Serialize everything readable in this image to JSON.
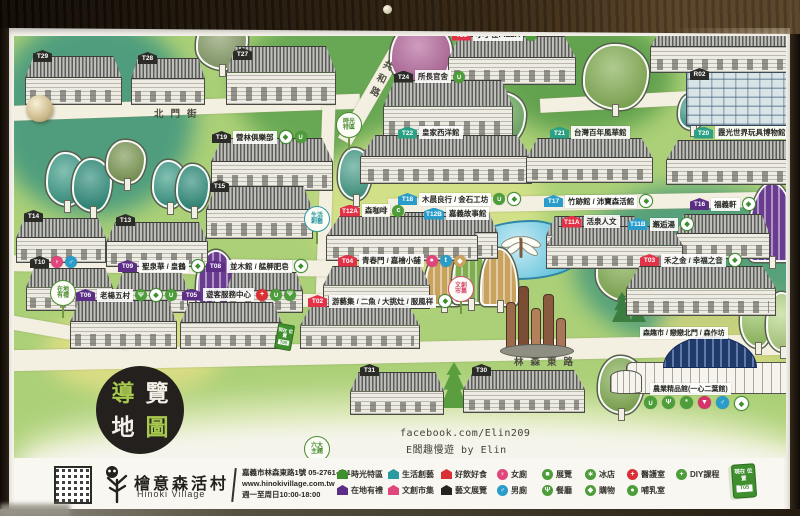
{
  "sign_title": {
    "guide_chars": [
      "導",
      "覽",
      "地",
      "圖"
    ]
  },
  "streets": {
    "beimen": "北門街",
    "gonghe": "共和路",
    "linsen": "林森東路"
  },
  "credit": {
    "line1": "facebook.com/Elin209",
    "line2": "E闆趣慢遊 by Elin"
  },
  "you_are_here": {
    "label": "現在位置",
    "code": "T05"
  },
  "marker_colors": {
    "black": "#2b2b28",
    "red": "#e23248",
    "blue": "#2a9cc9",
    "teal": "#2ba084",
    "purple": "#5c2e85",
    "pink": "#e0457b",
    "green": "#3f8f2f"
  },
  "map": {
    "area_tags": [
      {
        "line1": "時光",
        "line2": "特區",
        "color": "#4a8a2f",
        "x": 336,
        "y": 112
      },
      {
        "line1": "生活",
        "line2": "創藝",
        "color": "#2b9aa0",
        "x": 304,
        "y": 206
      },
      {
        "line1": "在地",
        "line2": "有禮",
        "color": "#4a8a2f",
        "x": 50,
        "y": 280
      },
      {
        "line1": "文創",
        "line2": "市集",
        "color": "#d84a6e",
        "x": 448,
        "y": 276
      },
      {
        "line1": "六大",
        "line2": "主題",
        "color": "#4a8a2f",
        "x": 304,
        "y": 436
      }
    ],
    "labels": [
      {
        "code": "T29",
        "cat": "black",
        "name": "",
        "icons": [],
        "x": 33,
        "y": 50
      },
      {
        "code": "T28",
        "cat": "black",
        "name": "",
        "icons": [],
        "x": 138,
        "y": 52
      },
      {
        "code": "T27",
        "cat": "black",
        "name": "",
        "icons": [],
        "x": 233,
        "y": 48
      },
      {
        "code": "T26",
        "cat": "red",
        "name": "小手在PIZZA",
        "icons": [
          "food"
        ],
        "x": 452,
        "y": 28
      },
      {
        "code": "T25",
        "cat": "black",
        "name": "阿里山林業史館",
        "icons": [],
        "x": 688,
        "y": 22
      },
      {
        "code": "R02",
        "cat": "black",
        "name": "",
        "icons": [],
        "x": 690,
        "y": 68
      },
      {
        "code": "T24",
        "cat": "black",
        "name": "所長官舍",
        "icons": [
          "drink"
        ],
        "x": 394,
        "y": 70
      },
      {
        "code": "T22",
        "cat": "teal",
        "name": "皇家西洋館",
        "icons": [],
        "x": 398,
        "y": 126
      },
      {
        "code": "T21",
        "cat": "teal",
        "name": "台灣百年風華館",
        "icons": [],
        "x": 550,
        "y": 126
      },
      {
        "code": "T20",
        "cat": "teal",
        "name": "霞光世界玩具博物館",
        "icons": [],
        "x": 694,
        "y": 126
      },
      {
        "code": "T19",
        "cat": "black",
        "name": "營林俱樂部",
        "icons": [
          "bag",
          "drink"
        ],
        "x": 212,
        "y": 130
      },
      {
        "code": "T15",
        "cat": "black",
        "name": "",
        "icons": [],
        "x": 210,
        "y": 180
      },
      {
        "code": "T14",
        "cat": "black",
        "name": "",
        "icons": [],
        "x": 24,
        "y": 210
      },
      {
        "code": "T13",
        "cat": "black",
        "name": "",
        "icons": [],
        "x": 116,
        "y": 214
      },
      {
        "code": "T18",
        "cat": "blue",
        "name": "木晨良行 / 金石工坊",
        "icons": [
          "drink",
          "bag"
        ],
        "x": 398,
        "y": 192
      },
      {
        "code": "T17",
        "cat": "blue",
        "name": "竹跡館 / 沛寶森活館",
        "icons": [
          "bag"
        ],
        "x": 544,
        "y": 194
      },
      {
        "code": "T16",
        "cat": "purple",
        "name": "福義軒",
        "icons": [
          "bag"
        ],
        "x": 690,
        "y": 197
      },
      {
        "code": "T12A",
        "cat": "red",
        "name": "森咖啡",
        "icons": [
          "coffee"
        ],
        "x": 340,
        "y": 204
      },
      {
        "code": "T12B",
        "cat": "blue",
        "name": "嘉義故事館",
        "icons": [],
        "x": 424,
        "y": 207
      },
      {
        "code": "T11A",
        "cat": "red",
        "name": "活泉人文",
        "icons": [],
        "x": 562,
        "y": 215
      },
      {
        "code": "T11B",
        "cat": "blue",
        "name": "邂逅湯",
        "icons": [
          "bag"
        ],
        "x": 628,
        "y": 217
      },
      {
        "code": "T10",
        "cat": "black",
        "name": "",
        "icons": [
          "female",
          "male"
        ],
        "x": 30,
        "y": 256
      },
      {
        "code": "T09",
        "cat": "purple",
        "name": "聖泉華 / 皇鶴",
        "icons": [
          "bag"
        ],
        "x": 118,
        "y": 259
      },
      {
        "code": "T08",
        "cat": "purple",
        "name": "並木館 / 艋舺肥皂",
        "icons": [
          "bag"
        ],
        "x": 206,
        "y": 259
      },
      {
        "code": "T06",
        "cat": "purple",
        "name": "老楊五村",
        "icons": [
          "food",
          "bag",
          "drink"
        ],
        "x": 76,
        "y": 288
      },
      {
        "code": "T05",
        "cat": "purple",
        "name": "遊客服務中心",
        "icons": [
          "cross",
          "drink",
          "food"
        ],
        "x": 182,
        "y": 288
      },
      {
        "code": "T04",
        "cat": "red",
        "name": "青春門 / 嘉檜小舖",
        "icons": [
          "photo",
          "key",
          "bagtan"
        ],
        "x": 338,
        "y": 254
      },
      {
        "code": "T02",
        "cat": "red",
        "name": "游藝集 / 二魚 / 大挑灶 / 服風祥",
        "icons": [
          "bag"
        ],
        "x": 308,
        "y": 294
      },
      {
        "code": "T03",
        "cat": "red",
        "name": "禾之金 / 幸福之音",
        "icons": [
          "bag"
        ],
        "x": 640,
        "y": 253
      },
      {
        "code": "T31",
        "cat": "black",
        "name": "",
        "icons": [],
        "x": 360,
        "y": 364
      },
      {
        "code": "T30",
        "cat": "black",
        "name": "",
        "icons": [],
        "x": 472,
        "y": 364
      }
    ],
    "shop_strip": {
      "text": "森趣市 / 戀戀北門 / 森作坊",
      "x": 638,
      "y": 327
    },
    "dome": {
      "name": "農業精品館(一心二葉館)",
      "x": 626,
      "y": 336,
      "w": 166,
      "h": 58,
      "label_x": 648,
      "label_y": 383,
      "icons": [
        "drink",
        "food",
        "leaf",
        "icecream",
        "male",
        "bag"
      ],
      "icons_x": 642,
      "icons_y": 396
    },
    "structures": [
      {
        "k": "house",
        "x": 25,
        "y": 56,
        "w": 97,
        "h": 46
      },
      {
        "k": "house",
        "x": 131,
        "y": 58,
        "w": 74,
        "h": 44
      },
      {
        "k": "house",
        "x": 226,
        "y": 46,
        "w": 110,
        "h": 56
      },
      {
        "k": "house",
        "x": 448,
        "y": 36,
        "w": 128,
        "h": 46
      },
      {
        "k": "house",
        "x": 650,
        "y": 26,
        "w": 142,
        "h": 44
      },
      {
        "k": "modern",
        "x": 686,
        "y": 72,
        "w": 106,
        "h": 52
      },
      {
        "k": "house",
        "x": 383,
        "y": 80,
        "w": 130,
        "h": 56
      },
      {
        "k": "house",
        "x": 360,
        "y": 135,
        "w": 172,
        "h": 46
      },
      {
        "k": "house",
        "x": 526,
        "y": 138,
        "w": 127,
        "h": 42
      },
      {
        "k": "house",
        "x": 666,
        "y": 140,
        "w": 132,
        "h": 42
      },
      {
        "k": "house",
        "x": 211,
        "y": 138,
        "w": 122,
        "h": 50
      },
      {
        "k": "house",
        "x": 206,
        "y": 186,
        "w": 107,
        "h": 50
      },
      {
        "k": "house",
        "x": 16,
        "y": 218,
        "w": 90,
        "h": 42
      },
      {
        "k": "house",
        "x": 106,
        "y": 222,
        "w": 102,
        "h": 42
      },
      {
        "k": "house",
        "x": 396,
        "y": 212,
        "w": 102,
        "h": 44
      },
      {
        "k": "house",
        "x": 546,
        "y": 216,
        "w": 97,
        "h": 40
      },
      {
        "k": "house",
        "x": 676,
        "y": 214,
        "w": 94,
        "h": 42
      },
      {
        "k": "house",
        "x": 326,
        "y": 216,
        "w": 152,
        "h": 42
      },
      {
        "k": "house",
        "x": 546,
        "y": 226,
        "w": 137,
        "h": 40
      },
      {
        "k": "house",
        "x": 26,
        "y": 268,
        "w": 87,
        "h": 40
      },
      {
        "k": "house",
        "x": 116,
        "y": 272,
        "w": 72,
        "h": 38
      },
      {
        "k": "house",
        "x": 226,
        "y": 272,
        "w": 77,
        "h": 38
      },
      {
        "k": "house",
        "x": 70,
        "y": 300,
        "w": 107,
        "h": 46
      },
      {
        "k": "house",
        "x": 180,
        "y": 302,
        "w": 102,
        "h": 44
      },
      {
        "k": "house",
        "x": 323,
        "y": 266,
        "w": 107,
        "h": 40
      },
      {
        "k": "house",
        "x": 300,
        "y": 306,
        "w": 120,
        "h": 40
      },
      {
        "k": "house",
        "x": 626,
        "y": 266,
        "w": 150,
        "h": 47
      },
      {
        "k": "house",
        "x": 350,
        "y": 372,
        "w": 94,
        "h": 40
      },
      {
        "k": "house",
        "x": 463,
        "y": 370,
        "w": 122,
        "h": 40
      }
    ],
    "trees": [
      {
        "k": "round",
        "x": 390,
        "y": 22,
        "w": 58,
        "h": 62,
        "c": "#b5679c"
      },
      {
        "k": "round",
        "x": 196,
        "y": 16,
        "w": 48,
        "h": 50,
        "c": "#8aa06b"
      },
      {
        "k": "round",
        "x": 583,
        "y": 44,
        "w": 62,
        "h": 62,
        "c": "#85b054"
      },
      {
        "k": "round",
        "x": 444,
        "y": 86,
        "w": 40,
        "h": 46,
        "c": "#49a08b"
      },
      {
        "k": "round",
        "x": 478,
        "y": 92,
        "w": 44,
        "h": 48,
        "c": "#6fae62"
      },
      {
        "k": "round",
        "x": 774,
        "y": 40,
        "w": 24,
        "h": 66,
        "c": "#49a08b"
      },
      {
        "k": "pine",
        "x": 730,
        "y": 64,
        "w": 32,
        "h": 58,
        "c": "#3a7d4f"
      },
      {
        "k": "pine",
        "x": 756,
        "y": 76,
        "w": 26,
        "h": 46,
        "c": "#3a7d4f"
      },
      {
        "k": "round",
        "x": 678,
        "y": 94,
        "w": 22,
        "h": 32,
        "c": "#49a08b"
      },
      {
        "k": "round",
        "x": 46,
        "y": 152,
        "w": 36,
        "h": 50,
        "c": "#3f9e8a"
      },
      {
        "k": "round",
        "x": 72,
        "y": 158,
        "w": 36,
        "h": 50,
        "c": "#2f8f7c"
      },
      {
        "k": "round",
        "x": 106,
        "y": 140,
        "w": 36,
        "h": 40,
        "c": "#7e9a55"
      },
      {
        "k": "round",
        "x": 152,
        "y": 160,
        "w": 30,
        "h": 44,
        "c": "#3f9e8a"
      },
      {
        "k": "round",
        "x": 176,
        "y": 164,
        "w": 30,
        "h": 44,
        "c": "#2f8f7c"
      },
      {
        "k": "round",
        "x": 338,
        "y": 148,
        "w": 30,
        "h": 48,
        "c": "#49a08b"
      },
      {
        "k": "fan",
        "x": 748,
        "y": 182,
        "w": 44,
        "h": 76,
        "c": "#6a3c8f"
      },
      {
        "k": "fan",
        "x": 196,
        "y": 250,
        "w": 36,
        "h": 50,
        "c": "#6a3c8f"
      },
      {
        "k": "fan",
        "x": 424,
        "y": 252,
        "w": 34,
        "h": 50,
        "c": "#c9a25e"
      },
      {
        "k": "fan",
        "x": 452,
        "y": 242,
        "w": 32,
        "h": 58,
        "c": "#7fae4e"
      },
      {
        "k": "fan",
        "x": 480,
        "y": 248,
        "w": 34,
        "h": 54,
        "c": "#c9a25e"
      },
      {
        "k": "round",
        "x": 596,
        "y": 236,
        "w": 56,
        "h": 62,
        "c": "#85b054"
      },
      {
        "k": "pine",
        "x": 562,
        "y": 222,
        "w": 24,
        "h": 40,
        "c": "#2f7d4f"
      },
      {
        "k": "pine",
        "x": 584,
        "y": 228,
        "w": 20,
        "h": 34,
        "c": "#2f7d4f"
      },
      {
        "k": "pine",
        "x": 612,
        "y": 292,
        "w": 20,
        "h": 30,
        "c": "#3a7d3f"
      },
      {
        "k": "pine",
        "x": 630,
        "y": 298,
        "w": 16,
        "h": 24,
        "c": "#3a7d3f"
      },
      {
        "k": "round",
        "x": 740,
        "y": 286,
        "w": 30,
        "h": 58,
        "c": "#9ec96a"
      },
      {
        "k": "round",
        "x": 766,
        "y": 292,
        "w": 28,
        "h": 56,
        "c": "#b9d98a"
      },
      {
        "k": "pine",
        "x": 440,
        "y": 362,
        "w": 28,
        "h": 46,
        "c": "#5a9e3f"
      },
      {
        "k": "round",
        "x": 598,
        "y": 356,
        "w": 42,
        "h": 54,
        "c": "#85b054"
      }
    ]
  },
  "footer": {
    "brand": {
      "name": "檜意森活村",
      "en": "Hinoki Village"
    },
    "contact": {
      "address": "嘉義市林森東路1號 05-2761-601",
      "website": "www.hinokivillage.com.tw",
      "hours": "週一至周日10:00-18:00"
    },
    "legend_houses": [
      {
        "label": "時光特區",
        "color": "#3f8f2f"
      },
      {
        "label": "在地有禮",
        "color": "#5c2e85"
      },
      {
        "label": "生活創藝",
        "color": "#2b9aa0"
      },
      {
        "label": "文創市集",
        "color": "#e0457b"
      },
      {
        "label": "好飲好食",
        "color": "#d93036"
      },
      {
        "label": "藝文展覽",
        "color": "#26221f"
      }
    ],
    "legend_circles": [
      {
        "label": "女廁",
        "icon": "female"
      },
      {
        "label": "男廁",
        "icon": "male"
      },
      {
        "label": "展覽",
        "icon": "exhibit"
      },
      {
        "label": "餐廳",
        "icon": "food"
      },
      {
        "label": "冰店",
        "icon": "ice"
      },
      {
        "label": "購物",
        "icon": "bag2"
      },
      {
        "label": "醫護室",
        "icon": "cross"
      },
      {
        "label": "哺乳室",
        "icon": "nursing"
      },
      {
        "label": "DIY課程",
        "icon": "diy"
      }
    ]
  }
}
